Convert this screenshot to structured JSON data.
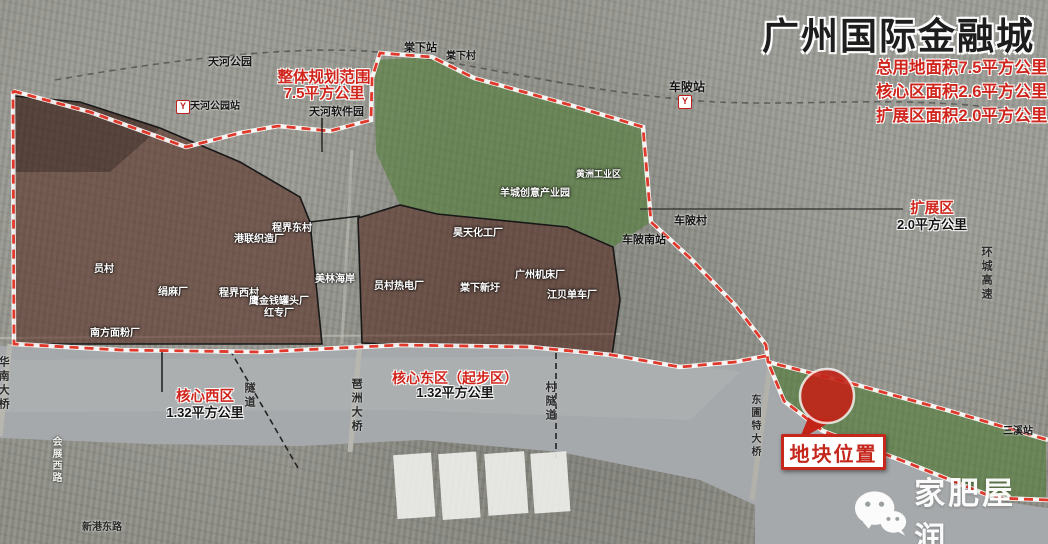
{
  "title": "广州国际金融城",
  "stats": {
    "line1": "总用地面积7.5平方公里",
    "line2": "核心区面积2.6平方公里",
    "line3": "扩展区面积2.0平方公里"
  },
  "planning_scope": {
    "title": "整体规划范围",
    "area": "7.5平方公里"
  },
  "zones": {
    "core_west": {
      "name": "核心西区",
      "area": "1.32平方公里"
    },
    "core_east": {
      "name": "核心东区（起步区）",
      "area": "1.32平方公里"
    },
    "expansion": {
      "name": "扩展区",
      "area": "2.0平方公里"
    }
  },
  "site_marker": {
    "label": "地块位置"
  },
  "watermark": {
    "text": "家肥屋润",
    "icon": "wechat-chat-bubbles"
  },
  "icons": {
    "metro": "guangzhou-metro-logo",
    "metro_glyph": "Y"
  },
  "colors": {
    "boundary_red": "#e0392b",
    "core_maroon": "rgba(77,31,20,0.52)",
    "zone_green": "rgba(74,124,48,0.55)",
    "marker_red": "#c22418",
    "label_red": "#d0251c"
  },
  "map_labels": [
    {
      "text": "天河公园"
    },
    {
      "text": "天河公园站"
    },
    {
      "text": "天河软件园"
    },
    {
      "text": "棠下站"
    },
    {
      "text": "棠下村"
    },
    {
      "text": "车陂站"
    },
    {
      "text": "车陂村"
    },
    {
      "text": "车陂南站"
    },
    {
      "text": "三溪站"
    },
    {
      "text": "黄洲工业区"
    },
    {
      "text": "羊城创意产业园"
    },
    {
      "text": "昊天化工厂"
    },
    {
      "text": "员村热电厂"
    },
    {
      "text": "棠下新圩"
    },
    {
      "text": "广州机床厂"
    },
    {
      "text": "江贝单车厂"
    },
    {
      "text": "员村"
    },
    {
      "text": "绢麻厂"
    },
    {
      "text": "程界西村"
    },
    {
      "text": "程界东村"
    },
    {
      "text": "港联织造厂"
    },
    {
      "text": "鹰金钱罐头厂"
    },
    {
      "text": "红专厂"
    },
    {
      "text": "南方面粉厂"
    },
    {
      "text": "美林海岸"
    },
    {
      "text": "华南大桥"
    },
    {
      "text": "琶洲大桥"
    },
    {
      "text": "隧道"
    },
    {
      "text": "村隧道"
    },
    {
      "text": "东圃特大桥"
    },
    {
      "text": "环城高速"
    },
    {
      "text": "会展西路"
    },
    {
      "text": "新港东路"
    }
  ]
}
